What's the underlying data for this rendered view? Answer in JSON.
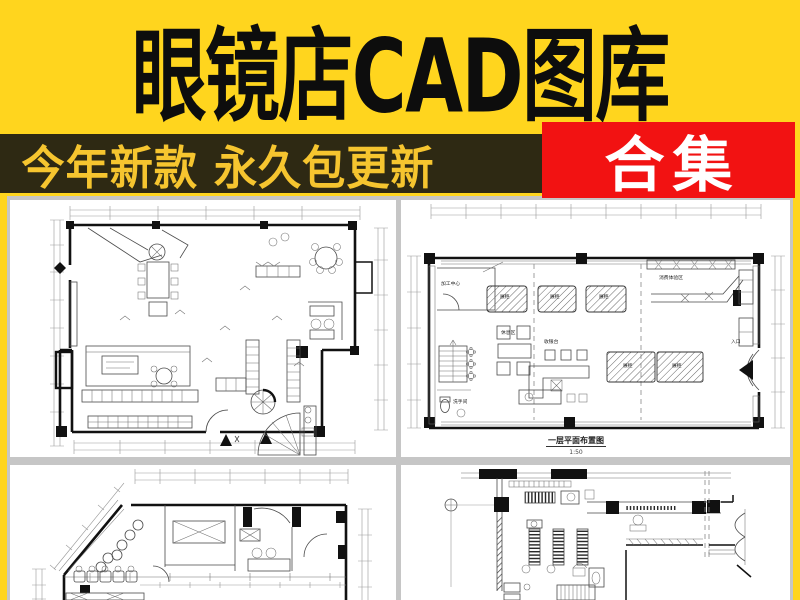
{
  "header": {
    "title": "眼镜店CAD图库"
  },
  "promo": {
    "tagline": "今年新款 永久包更新",
    "badge": "合集"
  },
  "colors": {
    "background_yellow": "#FFD51E",
    "tagline_bar": "#2E2913",
    "tagline_text": "#F6C52F",
    "badge_red": "#F21212",
    "badge_text": "#FFFFFF",
    "title_text": "#0D0D0D",
    "panel_gutter": "#C6C6C6"
  },
  "plans": {
    "floor_plan_main": {
      "caption": "一层平面布置图",
      "scale": "1:50",
      "labels": {
        "processing_center": "加工中心",
        "rest_area": "休息区",
        "cashier": "收银台",
        "washroom": "洗手间",
        "entrance": "入口",
        "display_case_1": "展柜",
        "display_case_2": "展柜",
        "display_case_3": "展柜",
        "display_counter_1": "展柜",
        "display_counter_2": "展柜",
        "experience_area": "消费体验区"
      }
    }
  }
}
